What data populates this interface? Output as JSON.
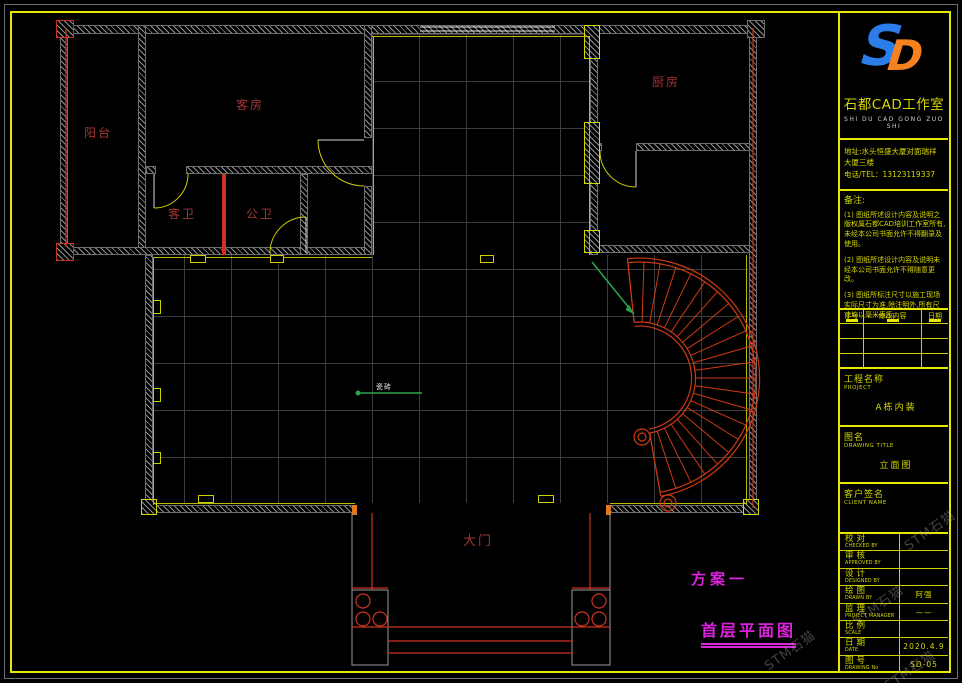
{
  "colors": {
    "frame_yellow": "#e6e600",
    "wall_gray": "#8f8f8f",
    "grid_gray": "#3d3d3d",
    "room_label_red": "#a23434",
    "magenta": "#dd22dd",
    "stair_red": "#cd3a12",
    "leader_green": "#2aa648",
    "logo_blue": "#2b7de9",
    "logo_orange": "#f5821f"
  },
  "plan": {
    "rooms": {
      "balcony": "阳台",
      "guest_room": "客房",
      "guest_bath": "客卫",
      "public_bath": "公卫",
      "kitchen": "厨房",
      "main_gate": "大门"
    },
    "annotations": {
      "tile": "瓷砖",
      "scheme": "方案一",
      "drawing_title": "首层平面图"
    }
  },
  "titleblock": {
    "logo": {
      "s": "S",
      "d": "D"
    },
    "studio_name": "石都CAD工作室",
    "studio_pinyin": "SHI DU CAD GONG ZUO SHI",
    "address_line1": "地址:水头恒盛大厦对面瑞祥",
    "address_line2": "大厦三楼",
    "phone": "电话/TEL：13123119337",
    "notes_title": "备注:",
    "notes": [
      "(1) 图纸所述设计内容及说明之版权属石都CAD培训工作室所有,未经本公司书面允许不得翻录及使用。",
      "(2) 图纸所述设计内容及说明未经本公司书面允许不得随意更改。",
      "(3) 图纸所标注尺寸以施工现场实际尺寸为准,除注明外,所有尺寸均以毫米表示。"
    ],
    "revision": {
      "headers": [
        "序号",
        "修改内容",
        "日期"
      ]
    },
    "project": {
      "label": "工程名称",
      "label_en": "PROJECT",
      "value": "A栋内装"
    },
    "drawing": {
      "label": "图名",
      "label_en": "DRAWING TITLE",
      "value": "立面图"
    },
    "client": {
      "label": "客户签名",
      "label_en": "CLIENT NAME"
    },
    "info_rows": [
      {
        "label": "校对",
        "en": "CHECKED BY",
        "value": ""
      },
      {
        "label": "审核",
        "en": "APPROVED BY",
        "value": ""
      },
      {
        "label": "设计",
        "en": "DESIGNED BY",
        "value": ""
      },
      {
        "label": "绘图",
        "en": "DRAWN BY",
        "value": "阿强"
      },
      {
        "label": "监理",
        "en": "PROJECT MANAGER",
        "value": "——"
      },
      {
        "label": "比例",
        "en": "SCALE",
        "value": ""
      },
      {
        "label": "日期",
        "en": "DATE",
        "value": "2020.4.9"
      },
      {
        "label": "图号",
        "en": "DRAWING No",
        "value": "SD-05"
      }
    ]
  },
  "watermark": {
    "text": "STM石猫"
  }
}
